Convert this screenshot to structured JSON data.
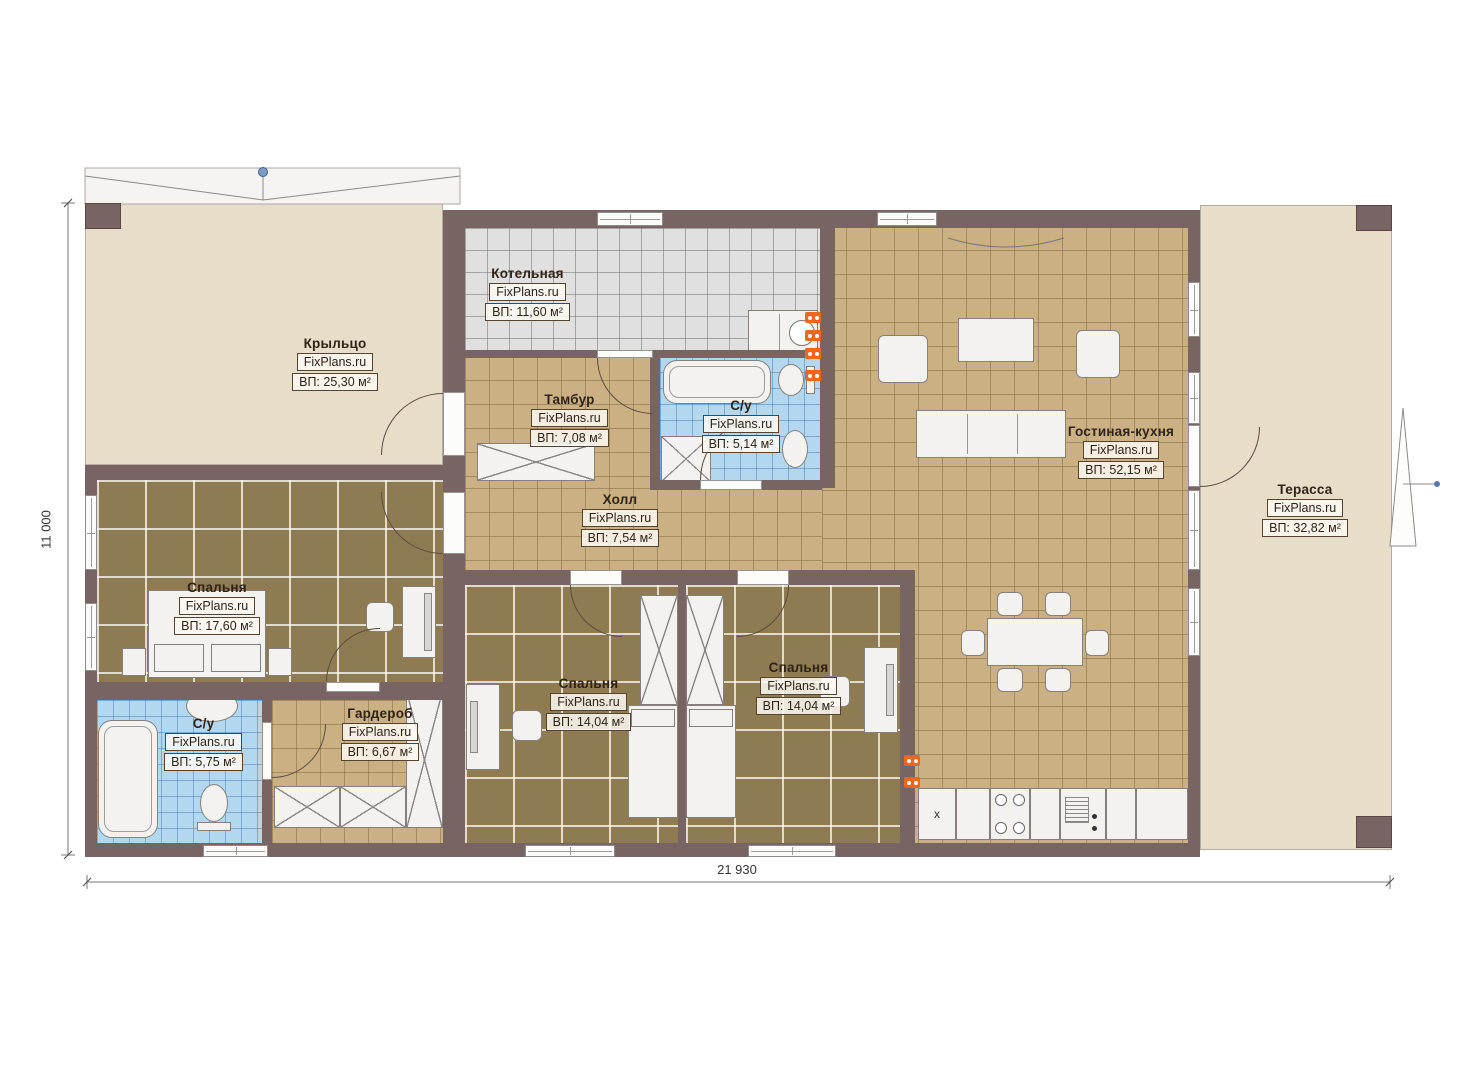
{
  "plan_title": "Одноэтажный дом — план этажа",
  "brand": "FixPlans.ru",
  "rooms": [
    {
      "id": "porch",
      "name": "Крыльцо",
      "area": "ВП: 25,30 м²"
    },
    {
      "id": "boiler",
      "name": "Котельная",
      "area": "ВП: 11,60 м²"
    },
    {
      "id": "vestibule",
      "name": "Тамбур",
      "area": "ВП: 7,08 м²"
    },
    {
      "id": "bath-top",
      "name": "С/у",
      "area": "ВП: 5,14 м²"
    },
    {
      "id": "living",
      "name": "Гостиная-кухня",
      "area": "ВП: 52,15 м²"
    },
    {
      "id": "terrace",
      "name": "Терасса",
      "area": "ВП: 32,82 м²"
    },
    {
      "id": "hall",
      "name": "Холл",
      "area": "ВП: 7,54 м²"
    },
    {
      "id": "bedroom-left",
      "name": "Спальня",
      "area": "ВП: 17,60 м²"
    },
    {
      "id": "bath-bottom",
      "name": "С/у",
      "area": "ВП: 5,75 м²"
    },
    {
      "id": "wardrobe",
      "name": "Гардероб",
      "area": "ВП: 6,67 м²"
    },
    {
      "id": "bedroom-mid1",
      "name": "Спальня",
      "area": "ВП: 14,04 м²"
    },
    {
      "id": "bedroom-mid2",
      "name": "Спальня",
      "area": "ВП: 14,04 м²"
    }
  ],
  "dimensions": {
    "total_width": "21 930",
    "total_height": "11 000"
  },
  "kitchen": {
    "sink_label": "x"
  },
  "colors": {
    "wall": "#786462",
    "floor_tan": "#cbb083",
    "floor_dark": "#8e7b51",
    "floor_blue": "#b4d7f0",
    "floor_gray": "#e0e0e0",
    "floor_beige": "#e7ddc8",
    "radiator_orange": "#f2661c"
  }
}
